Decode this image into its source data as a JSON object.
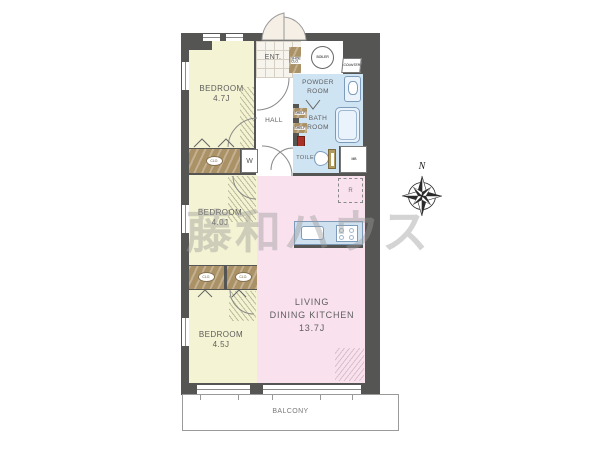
{
  "watermark": "藤和ハウス",
  "compass": {
    "north": "N"
  },
  "rooms": {
    "bedroom1": {
      "name": "BEDROOM",
      "size": "4.7J"
    },
    "bedroom2": {
      "name": "BEDROOM",
      "size": "4.0J"
    },
    "bedroom3": {
      "name": "BEDROOM",
      "size": "4.5J"
    },
    "ldk": {
      "line1": "LIVING",
      "line2": "DINING KITCHEN",
      "size": "13.7J"
    },
    "powder_room": {
      "line1": "POWDER",
      "line2": "ROOM"
    },
    "bath_room": {
      "line1": "BATH",
      "line2": "ROOM"
    },
    "toilet": {
      "name": "TOILET"
    },
    "hall": {
      "name": "HALL"
    },
    "entrance": {
      "name": "ENT."
    },
    "balcony": {
      "name": "BALCONY"
    }
  },
  "fixtures": {
    "shoes_closet": "SHOES CLO.",
    "boiler": "BOILER",
    "counter": "COUNTER",
    "shelf_upper": "SHELF",
    "shelf_lower": "SHELF",
    "closet_top": "CLO.",
    "closet_mid_left": "CLO.",
    "closet_mid_right": "CLO.",
    "washing_machine": "W",
    "meter_box": "MB",
    "refrigerator": "R"
  },
  "colors": {
    "wall": "#555553",
    "bedroom_fill": "#f4f3d3",
    "ldk_fill": "#f9e2ee",
    "wet_area_fill": "#cfe4f3",
    "closet_fill": "#ab9166",
    "watermark_gray": "#9a9a9a"
  }
}
